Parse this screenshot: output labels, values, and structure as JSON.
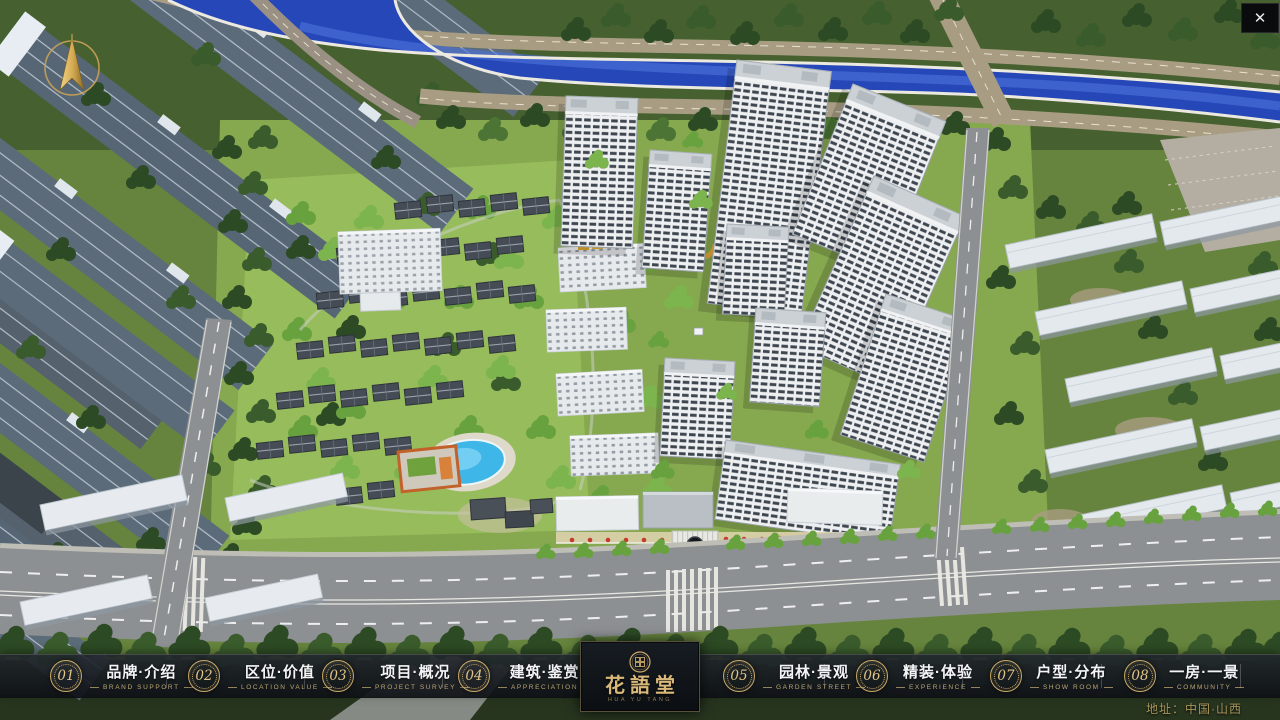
{
  "ui": {
    "close_glyph": "✕",
    "address": "地址：中国·山西"
  },
  "logo": {
    "name_zh": "花語堂",
    "tagline": "HUA YU TANG"
  },
  "nav": {
    "items": [
      {
        "number": "01",
        "zh": "品牌·介绍",
        "en": "BRAND SUPPORT"
      },
      {
        "number": "02",
        "zh": "区位·价值",
        "en": "LOCATION VALUE"
      },
      {
        "number": "03",
        "zh": "项目·概况",
        "en": "PROJECT SURVEY"
      },
      {
        "number": "04",
        "zh": "建筑·鉴赏",
        "en": "APPRECIATION"
      },
      {
        "number": "05",
        "zh": "园林·景观",
        "en": "GARDEN STREET"
      },
      {
        "number": "06",
        "zh": "精装·体验",
        "en": "EXPERIENCE"
      },
      {
        "number": "07",
        "zh": "户型·分布",
        "en": "SHOW ROOM"
      },
      {
        "number": "08",
        "zh": "一房·一景",
        "en": "COMMUNITY"
      }
    ]
  },
  "colors": {
    "accent_gold": "#c9a967",
    "nav_bg": "#141920",
    "river_blue": "#2647b8",
    "tree_green": "#2c4a24",
    "lawn_green": "#86a84f",
    "road_gray": "#8d9093"
  }
}
